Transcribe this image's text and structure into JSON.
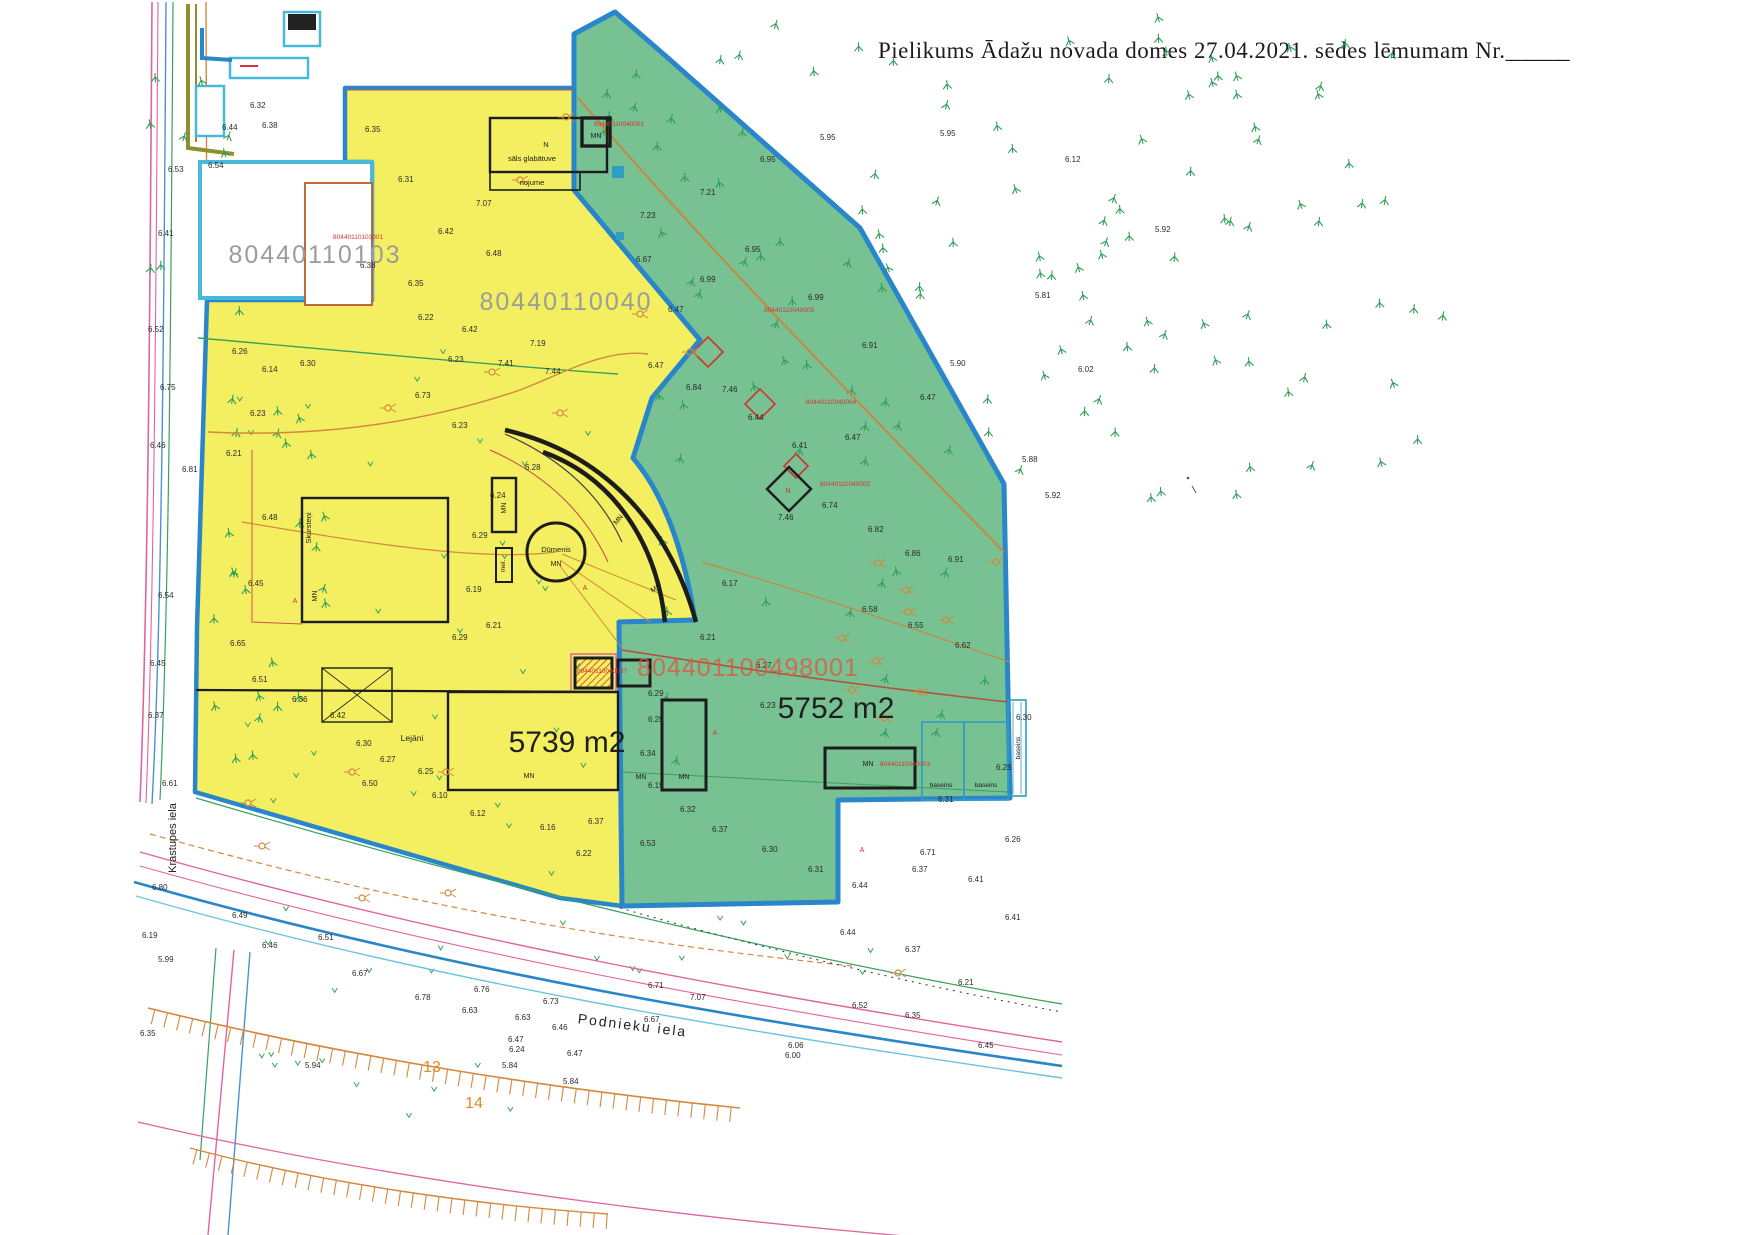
{
  "header": {
    "text": "Pielikums Ādažu novada domes 27.04.2021. sēdes lēmumam Nr.",
    "blank": "______"
  },
  "parcels": {
    "white": {
      "id": "80440110103",
      "building_no": "80440110103001"
    },
    "yellow": {
      "id": "80440110040",
      "area": "5739 m2"
    },
    "green": {
      "area": "5752 m2",
      "big_building_no": "804401100498001"
    }
  },
  "streets": {
    "left": "Krastupes iela",
    "bottom": "Podnieku iela"
  },
  "buildings": {
    "salt_n": "N",
    "salt": "sāls glabātuve",
    "nojume": "nojume",
    "dumenis": "Dūmenis",
    "skursteni": "Skursteņi",
    "mel": "mel.",
    "lejani": "Lejāni",
    "mn": "MN",
    "baseins": "baseins"
  },
  "plot_numbers": [
    {
      "x": 432,
      "y": 1072,
      "t": "13"
    },
    {
      "x": 474,
      "y": 1108,
      "t": "14"
    }
  ],
  "red_numbers": [
    {
      "x": 333,
      "y": 239,
      "t": "80440110103001"
    },
    {
      "x": 594,
      "y": 126,
      "t": "80440110040001"
    },
    {
      "x": 764,
      "y": 312,
      "t": "80440110040005"
    },
    {
      "x": 806,
      "y": 404,
      "t": "80440110040004"
    },
    {
      "x": 820,
      "y": 486,
      "t": "80440110040002"
    },
    {
      "x": 880,
      "y": 766,
      "t": "80440110040003"
    },
    {
      "x": 577,
      "y": 673,
      "t": "80440110040007"
    }
  ],
  "mn_labels": [
    {
      "x": 596,
      "y": 138,
      "r": 0
    },
    {
      "x": 506,
      "y": 508,
      "r": -90
    },
    {
      "x": 317,
      "y": 596,
      "r": -90
    },
    {
      "x": 556,
      "y": 566,
      "r": 0
    },
    {
      "x": 620,
      "y": 521,
      "r": -50
    },
    {
      "x": 657,
      "y": 590,
      "r": -30
    },
    {
      "x": 529,
      "y": 778,
      "r": 0
    },
    {
      "x": 641,
      "y": 779,
      "r": 0
    },
    {
      "x": 684,
      "y": 779,
      "r": 0
    },
    {
      "x": 868,
      "y": 766,
      "r": 0
    }
  ],
  "baseins_labels": [
    {
      "x": 941,
      "y": 787,
      "r": 0
    },
    {
      "x": 986,
      "y": 787,
      "r": 0
    },
    {
      "x": 1020,
      "y": 748,
      "r": -90
    }
  ],
  "misc_labels": [
    {
      "x": 788,
      "y": 493,
      "t": "N"
    },
    {
      "x": 585,
      "y": 590,
      "t": "A"
    },
    {
      "x": 715,
      "y": 735,
      "t": "A"
    },
    {
      "x": 295,
      "y": 603,
      "t": "A"
    },
    {
      "x": 862,
      "y": 852,
      "t": "A"
    }
  ],
  "spot_heights": [
    [
      168,
      172,
      "6.53"
    ],
    [
      158,
      236,
      "6.41"
    ],
    [
      148,
      332,
      "6.52"
    ],
    [
      160,
      390,
      "6.75"
    ],
    [
      150,
      448,
      "6.46"
    ],
    [
      182,
      472,
      "6.81"
    ],
    [
      158,
      598,
      "6.54"
    ],
    [
      150,
      666,
      "6.45"
    ],
    [
      148,
      718,
      "6.37"
    ],
    [
      162,
      786,
      "6.61"
    ],
    [
      152,
      890,
      "6.80"
    ],
    [
      142,
      938,
      "6.19"
    ],
    [
      158,
      962,
      "5.99"
    ],
    [
      140,
      1036,
      "6.35"
    ],
    [
      208,
      168,
      "6.54"
    ],
    [
      222,
      130,
      "6.44"
    ],
    [
      250,
      108,
      "6.32"
    ],
    [
      262,
      128,
      "6.38"
    ],
    [
      365,
      132,
      "6.35"
    ],
    [
      398,
      182,
      "6.31"
    ],
    [
      476,
      206,
      "7.07"
    ],
    [
      438,
      234,
      "6.42"
    ],
    [
      486,
      256,
      "6.48"
    ],
    [
      408,
      286,
      "6.35"
    ],
    [
      360,
      268,
      "6.38"
    ],
    [
      418,
      320,
      "6.22"
    ],
    [
      462,
      332,
      "6.42"
    ],
    [
      530,
      346,
      "7.19"
    ],
    [
      448,
      362,
      "6.23"
    ],
    [
      498,
      366,
      "7.41"
    ],
    [
      545,
      374,
      "7.44"
    ],
    [
      415,
      398,
      "6.73"
    ],
    [
      452,
      428,
      "6.23"
    ],
    [
      300,
      366,
      "6.30"
    ],
    [
      262,
      372,
      "6.14"
    ],
    [
      232,
      354,
      "6.26"
    ],
    [
      250,
      416,
      "6.23"
    ],
    [
      226,
      456,
      "6.21"
    ],
    [
      262,
      520,
      "6.48"
    ],
    [
      248,
      586,
      "6.45"
    ],
    [
      230,
      646,
      "6.65"
    ],
    [
      252,
      682,
      "6.51"
    ],
    [
      292,
      702,
      "6.36"
    ],
    [
      330,
      718,
      "6.42"
    ],
    [
      356,
      746,
      "6.30"
    ],
    [
      380,
      762,
      "6.27"
    ],
    [
      418,
      774,
      "6.25"
    ],
    [
      362,
      786,
      "6.50"
    ],
    [
      432,
      798,
      "6.10"
    ],
    [
      470,
      816,
      "6.12"
    ],
    [
      540,
      830,
      "6.16"
    ],
    [
      588,
      824,
      "6.37"
    ],
    [
      640,
      846,
      "6.53"
    ],
    [
      576,
      856,
      "6.22"
    ],
    [
      525,
      470,
      "6.28"
    ],
    [
      490,
      498,
      "6.24"
    ],
    [
      472,
      538,
      "6.29"
    ],
    [
      466,
      592,
      "6.19"
    ],
    [
      452,
      640,
      "6.29"
    ],
    [
      486,
      628,
      "6.21"
    ],
    [
      648,
      368,
      "6.47"
    ],
    [
      686,
      390,
      "6.84"
    ],
    [
      722,
      392,
      "7.46"
    ],
    [
      748,
      420,
      "6.44"
    ],
    [
      792,
      448,
      "6.41"
    ],
    [
      845,
      440,
      "6.47"
    ],
    [
      778,
      520,
      "7.46"
    ],
    [
      822,
      508,
      "6.74"
    ],
    [
      868,
      532,
      "6.82"
    ],
    [
      905,
      556,
      "6.86"
    ],
    [
      948,
      562,
      "6.91"
    ],
    [
      862,
      612,
      "6.58"
    ],
    [
      908,
      628,
      "6.55"
    ],
    [
      955,
      648,
      "6.62"
    ],
    [
      722,
      586,
      "6.17"
    ],
    [
      700,
      640,
      "6.21"
    ],
    [
      756,
      668,
      "6.27"
    ],
    [
      648,
      696,
      "6.29"
    ],
    [
      648,
      722,
      "6.25"
    ],
    [
      640,
      756,
      "6.34"
    ],
    [
      648,
      788,
      "6.19"
    ],
    [
      680,
      812,
      "6.32"
    ],
    [
      712,
      832,
      "6.37"
    ],
    [
      762,
      852,
      "6.30"
    ],
    [
      808,
      872,
      "6.31"
    ],
    [
      852,
      888,
      "6.44"
    ],
    [
      912,
      872,
      "6.37"
    ],
    [
      968,
      882,
      "6.41"
    ],
    [
      1005,
      842,
      "6.26"
    ],
    [
      938,
      802,
      "6.31"
    ],
    [
      996,
      770,
      "6.28"
    ],
    [
      1016,
      720,
      "6.30"
    ],
    [
      760,
      708,
      "6.23"
    ],
    [
      636,
      262,
      "6.67"
    ],
    [
      668,
      312,
      "6.47"
    ],
    [
      700,
      282,
      "6.99"
    ],
    [
      745,
      252,
      "6.95"
    ],
    [
      808,
      300,
      "6.99"
    ],
    [
      862,
      348,
      "6.91"
    ],
    [
      920,
      400,
      "6.47"
    ],
    [
      640,
      218,
      "7.23"
    ],
    [
      700,
      195,
      "7.21"
    ],
    [
      760,
      162,
      "6.95"
    ],
    [
      940,
      136,
      "5.95"
    ],
    [
      1035,
      298,
      "5.81"
    ],
    [
      950,
      366,
      "5.90"
    ],
    [
      1078,
      372,
      "6.02"
    ],
    [
      1022,
      462,
      "5.88"
    ],
    [
      1045,
      498,
      "5.92"
    ],
    [
      1155,
      232,
      "5.92"
    ],
    [
      1065,
      162,
      "6.12"
    ],
    [
      820,
      140,
      "5.95"
    ],
    [
      474,
      992,
      "6.76"
    ],
    [
      543,
      1004,
      "6.73"
    ],
    [
      515,
      1020,
      "6.63"
    ],
    [
      552,
      1030,
      "6.46"
    ],
    [
      508,
      1042,
      "6.47"
    ],
    [
      509,
      1052,
      "6.24"
    ],
    [
      567,
      1056,
      "6.47"
    ],
    [
      502,
      1068,
      "5.84"
    ],
    [
      563,
      1084,
      "5.84"
    ],
    [
      644,
      1022,
      "6.67"
    ],
    [
      648,
      988,
      "6.71"
    ],
    [
      788,
      1048,
      "6.06"
    ],
    [
      785,
      1058,
      "6.00"
    ],
    [
      690,
      1000,
      "7.07"
    ],
    [
      232,
      918,
      "6.49"
    ],
    [
      262,
      948,
      "6.46"
    ],
    [
      318,
      940,
      "6.51"
    ],
    [
      352,
      976,
      "6.67"
    ],
    [
      415,
      1000,
      "6.78"
    ],
    [
      462,
      1013,
      "6.63"
    ],
    [
      305,
      1068,
      "5.94"
    ],
    [
      840,
      935,
      "6.44"
    ],
    [
      905,
      952,
      "6.37"
    ],
    [
      852,
      1008,
      "6.52"
    ],
    [
      905,
      1018,
      "6.35"
    ],
    [
      958,
      985,
      "6.21"
    ],
    [
      978,
      1048,
      "6.45"
    ],
    [
      1005,
      920,
      "6.41"
    ],
    [
      920,
      855,
      "6.71"
    ]
  ],
  "pole_symbols": [
    [
      878,
      563
    ],
    [
      906,
      590
    ],
    [
      842,
      638
    ],
    [
      876,
      661
    ],
    [
      908,
      612
    ],
    [
      946,
      620
    ],
    [
      996,
      562
    ],
    [
      852,
      690
    ],
    [
      884,
      718
    ],
    [
      920,
      692
    ],
    [
      690,
      352
    ],
    [
      640,
      314
    ],
    [
      560,
      413
    ],
    [
      492,
      372
    ],
    [
      388,
      408
    ],
    [
      352,
      772
    ],
    [
      446,
      772
    ],
    [
      248,
      803
    ],
    [
      262,
      846
    ],
    [
      448,
      893
    ],
    [
      362,
      898
    ],
    [
      898,
      973
    ],
    [
      566,
      117
    ],
    [
      520,
      180
    ]
  ],
  "diamonds": [
    {
      "x": 708,
      "y": 352,
      "r": 15,
      "c": "red"
    },
    {
      "x": 760,
      "y": 404,
      "r": 15,
      "c": "red"
    },
    {
      "x": 796,
      "y": 466,
      "r": 12,
      "c": "red"
    },
    {
      "x": 789,
      "y": 489,
      "r": 22,
      "c": "black"
    }
  ],
  "tree_fields": [
    {
      "x0": 640,
      "x1": 1445,
      "y0": 16,
      "y1": 505,
      "count": 95,
      "seed": 11,
      "filter": "rightOfDiag"
    },
    {
      "x0": 600,
      "x1": 990,
      "y0": 45,
      "y1": 470,
      "count": 30,
      "seed": 23,
      "filter": "greenTop"
    },
    {
      "x0": 650,
      "x1": 1000,
      "y0": 490,
      "y1": 780,
      "count": 14,
      "seed": 31,
      "filter": "none"
    },
    {
      "x0": 210,
      "x1": 335,
      "y0": 310,
      "y1": 775,
      "count": 26,
      "seed": 41,
      "filter": "none"
    },
    {
      "x0": 142,
      "x1": 232,
      "y0": 60,
      "y1": 300,
      "count": 8,
      "seed": 51,
      "filter": "none"
    }
  ],
  "v_fields": [
    {
      "x0": 235,
      "x1": 600,
      "y0": 320,
      "y1": 880,
      "count": 30,
      "seed": 61
    },
    {
      "x0": 240,
      "x1": 900,
      "y0": 908,
      "y1": 1000,
      "count": 16,
      "seed": 71
    },
    {
      "x0": 260,
      "x1": 520,
      "y0": 1040,
      "y1": 1120,
      "count": 10,
      "seed": 81
    }
  ],
  "colors": {
    "parcel_yellow": "#f3ef60",
    "parcel_green": "#77c193",
    "boundary_blue": "#2a86ca",
    "parcel_cyan": "#49b8da",
    "building_black": "#1c1c1c",
    "red": "#d23430",
    "red_big": "#e0563c",
    "gray_id": "#9c9c9c",
    "orange": "#d4883c",
    "pink": "#e0649f",
    "green_line": "#3aa05c",
    "tree_green": "#2f9e57",
    "blue_thin": "#4a94cc",
    "cyan_thin": "#6cc3e0",
    "brown": "#b0543c",
    "olive": "#8f8f2e",
    "pool_cyan": "#2f9ec0",
    "text_dark": "#2b2b2b",
    "plot_orange": "#e08a28"
  }
}
